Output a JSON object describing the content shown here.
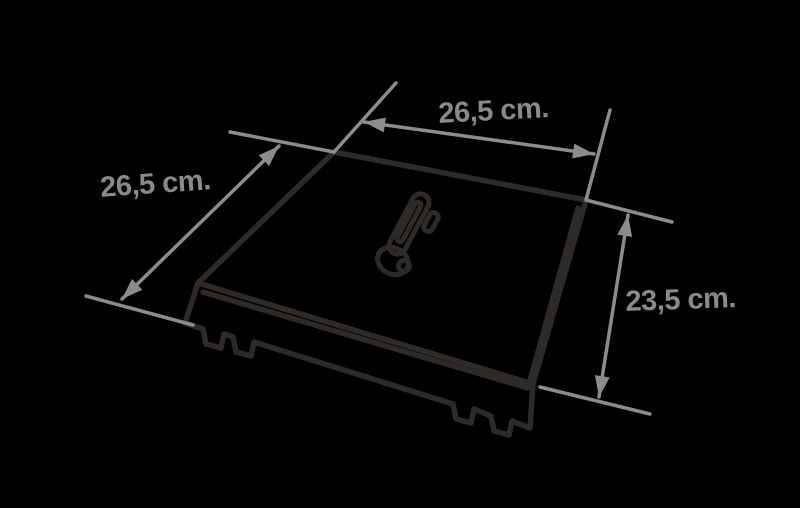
{
  "diagram": {
    "kind": "isometric-dimension-drawing",
    "subject": "square lid with center handle and clip tabs",
    "labels": {
      "top": "26,5 cm.",
      "left": "26,5 cm.",
      "right": "23,5 cm."
    },
    "colors": {
      "background": "#000000",
      "object_stroke": "#2e2a27",
      "dimension_lines": "#8c8c8c",
      "label_text": "#8a8a8a"
    }
  }
}
